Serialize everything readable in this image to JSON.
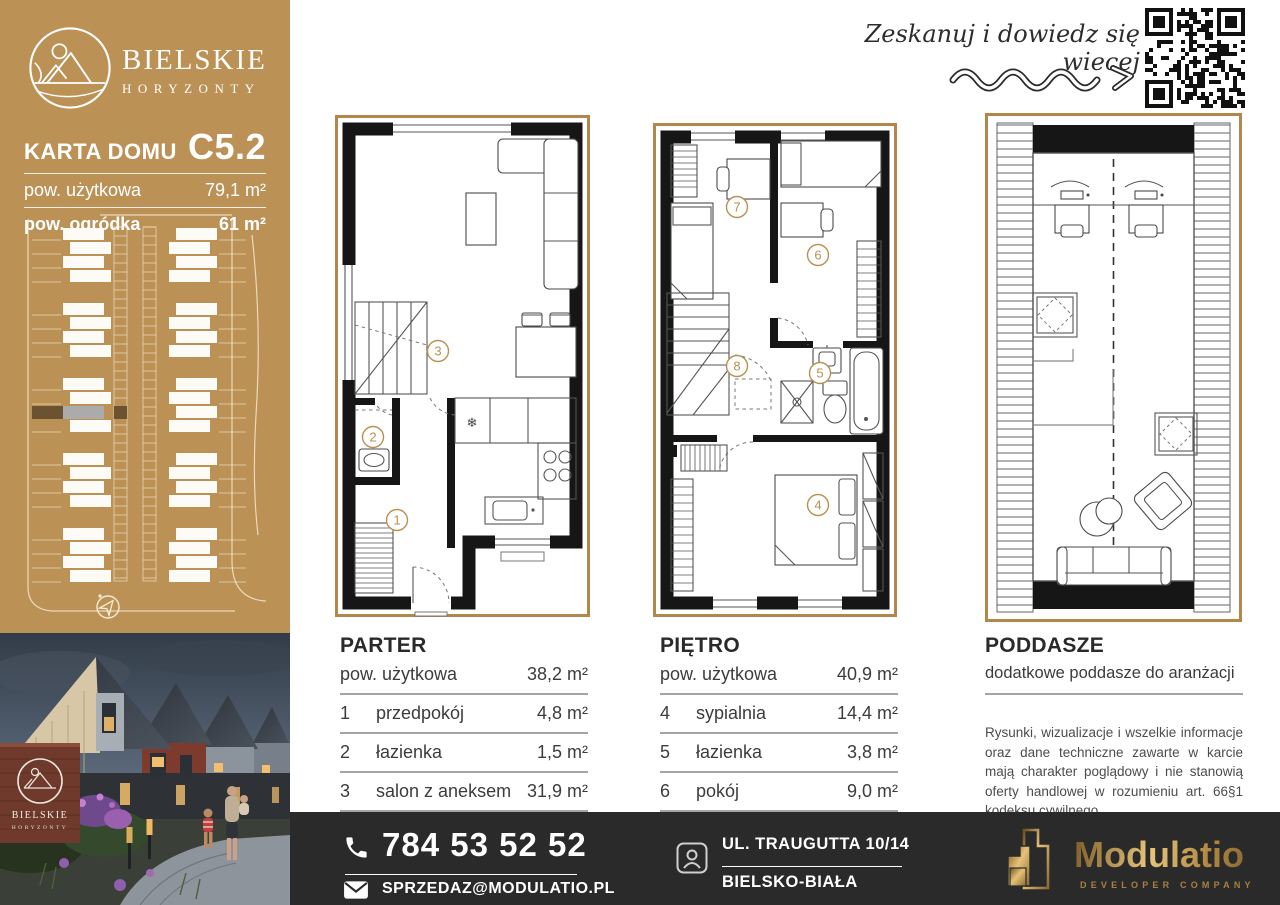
{
  "brand": {
    "line1": "BIELSKIE",
    "line2": "HORYZONTY"
  },
  "card": {
    "title": "KARTA DOMU",
    "unit": "C5.2",
    "rows": [
      {
        "label": "pow. użytkowa",
        "value": "79,1 m²"
      },
      {
        "label": "pow. ogródka",
        "value": "61 m²"
      }
    ]
  },
  "scan": {
    "text": "Zeskanuj i dowiedz się wiecej"
  },
  "floors": [
    {
      "name": "PARTER",
      "area_label": "pow. użytkowa",
      "area_value": "38,2 m²",
      "rooms": [
        {
          "no": "1",
          "name": "przedpokój",
          "area": "4,8 m²"
        },
        {
          "no": "2",
          "name": "łazienka",
          "area": "1,5 m²"
        },
        {
          "no": "3",
          "name": "salon z aneksem",
          "area": "31,9 m²"
        }
      ]
    },
    {
      "name": "PIĘTRO",
      "area_label": "pow. użytkowa",
      "area_value": "40,9 m²",
      "rooms": [
        {
          "no": "4",
          "name": "sypialnia",
          "area": "14,4 m²"
        },
        {
          "no": "5",
          "name": "łazienka",
          "area": "3,8 m²"
        },
        {
          "no": "6",
          "name": "pokój",
          "area": "9,0 m²"
        },
        {
          "no": "7",
          "name": "pokój",
          "area": "7,2 m²"
        },
        {
          "no": "8",
          "name": "komunikacja",
          "area": "6,5 m²"
        }
      ]
    },
    {
      "name": "PODDASZE",
      "subtitle": "dodatkowe poddasze do aranżacji",
      "disclaimer": "Rysunki, wizualizacje i wszelkie informacje oraz dane techniczne zawarte w karcie mają charakter poglądowy i nie stanowią oferty handlowej w rozumieniu art. 66§1 kodeksu cywilnego."
    }
  ],
  "photo": {
    "sign_line1": "BIELSKIE",
    "sign_line2": "HORYZONTY"
  },
  "contact": {
    "phone": "784 53 52 52",
    "email": "SPRZEDAZ@MODULATIO.PL",
    "address_line1": "UL. TRAUGUTTA 10/14",
    "address_line2": "BIELSKO-BIAŁA"
  },
  "developer": {
    "name": "Modulatio",
    "tagline": "DEVELOPER COMPANY"
  },
  "colors": {
    "sidebar_gold": "#bb9156",
    "plan_frame_gold": "#b3874a",
    "marker_gold": "#b9904f",
    "bar_dark": "#2b2a2a",
    "highlight_brown": "#6b5230",
    "highlight_gray": "#ababab"
  }
}
